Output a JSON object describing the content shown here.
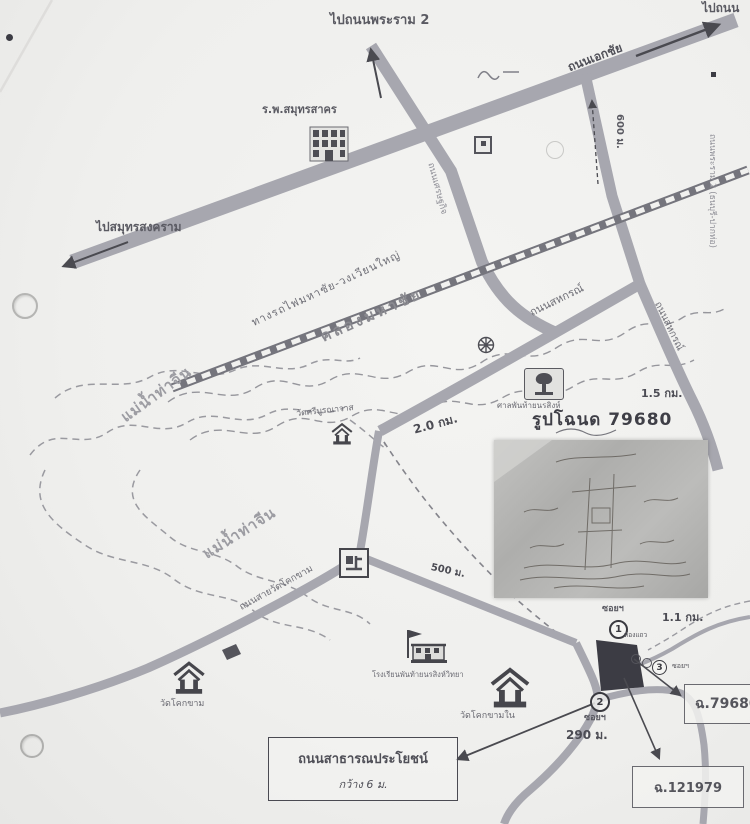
{
  "map": {
    "directions": {
      "rama2": "ไปถนนพระราม 2",
      "samut_songkhram": "ไปสมุทรสงคราม",
      "top_right": "ไปถนน"
    },
    "roads": {
      "ekachai": "ถนนเอกชัย",
      "setthakit": "ถนนเศรษฐกิจ",
      "sahakorn_upper": "ถนนสหกรณ์",
      "sahakorn_lower": "ถนนสหกรณ์",
      "rama2_bypass": "ถนนพระราม 2 (ธนบุรี-ปากท่อ)",
      "wat_khokkham_road": "ถนนสายวัดโคกขาม"
    },
    "railway_label": "ทางรถไฟมหาชัย-วงเวียนใหญ่",
    "water": {
      "canal": "คลองมหาชัย",
      "river_upper": "แม่น้ำท่าจีน",
      "river_lower": "แม่น้ำท่าจีน"
    },
    "places": {
      "hospital": "ร.พ.สมุทรสาคร",
      "wat_sri_buranawat": "วัดศรีบูรณาวาส",
      "shrine": "ศาลพันท้ายนรสิงห์",
      "school": "โรงเรียนพันท้ายนรสิงห์วิทยา",
      "wat_khokkham": "วัดโคกขาม",
      "wat_khokkham_nai": "วัดโคกขามใน",
      "rowhouses": "ห้องแถว"
    },
    "distances": {
      "d600": "600 ม.",
      "d2km": "2.0 กม.",
      "d1_5km": "1.5 กม.",
      "d500": "500 ม.",
      "d1_1km": "1.1 กม.",
      "d290": "290 ม."
    },
    "deed": {
      "title": "รูปโฉนด 79680",
      "ref_main": "ฉ.79680",
      "ref_secondary": "ฉ.121979"
    },
    "sois": {
      "s1": {
        "label": "ซอยฯ",
        "num": "1"
      },
      "s2": {
        "label": "ซอยฯ",
        "num": "2"
      },
      "s3": {
        "label": "ซอยฯ",
        "num": "3"
      }
    },
    "annotation_box": {
      "line1": "ถนนสาธารณประโยชน์",
      "line2": "กว้าง 6 ม."
    },
    "colors": {
      "road": "#a7a7af",
      "parcel": "#3c3c44",
      "ink": "#5a5a62",
      "paper": "#f2f2f0"
    }
  }
}
